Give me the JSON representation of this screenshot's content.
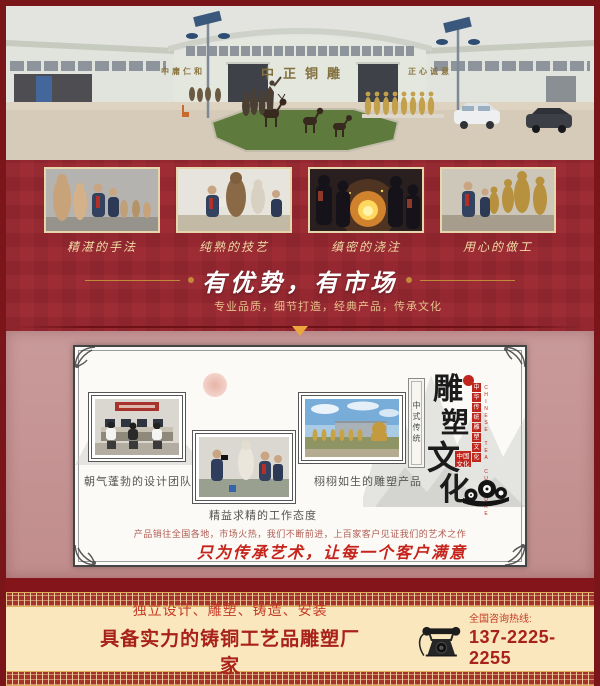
{
  "panorama": {
    "sign_left": "中庸仁和",
    "sign_center": "中正铜雕",
    "sign_right": "正心诚意"
  },
  "process_photos": [
    {
      "caption": "精湛的手法"
    },
    {
      "caption": "纯熟的技艺"
    },
    {
      "caption": "缜密的浇注"
    },
    {
      "caption": "用心的做工"
    }
  ],
  "advantage": {
    "title": "有优势，有市场",
    "subtitle": "专业品质，细节打造，经典产品，传承文化"
  },
  "culture_card": {
    "photos": [
      {
        "caption": "朝气蓬勃的设计团队"
      },
      {
        "caption": "精益求精的工作态度"
      },
      {
        "caption": "栩栩如生的雕塑产品"
      }
    ],
    "vertical_title": [
      "雕",
      "塑",
      "文",
      "化"
    ],
    "tablet_text": "中式传统",
    "seal_chars": [
      "中",
      "华",
      "传",
      "统",
      "雕",
      "塑",
      "文",
      "化"
    ],
    "seal_english": "CHINESE TEA CULTURE",
    "square_seal_text": "中国文化",
    "market_line": "产品销往全国各地，市场火热，我们不断前进，上百家客户见证我们的艺术之作",
    "slogan": "只为传承艺术，让每一个客户满意"
  },
  "footer": {
    "services": "独立设计、雕塑、铸造、安装",
    "company": "具备实力的铸铜工艺品雕塑厂家",
    "hotline_label": "全国咨询热线:",
    "phone": "137-2225-2255"
  },
  "colors": {
    "page_border": "#7a151a",
    "main_red": "#9c2931",
    "pink_panel": "#c69494",
    "gold": "#c9963e",
    "footer_cream": "#fbe7bd",
    "accent_red": "#a8221a",
    "seal_red": "#bf271e"
  }
}
